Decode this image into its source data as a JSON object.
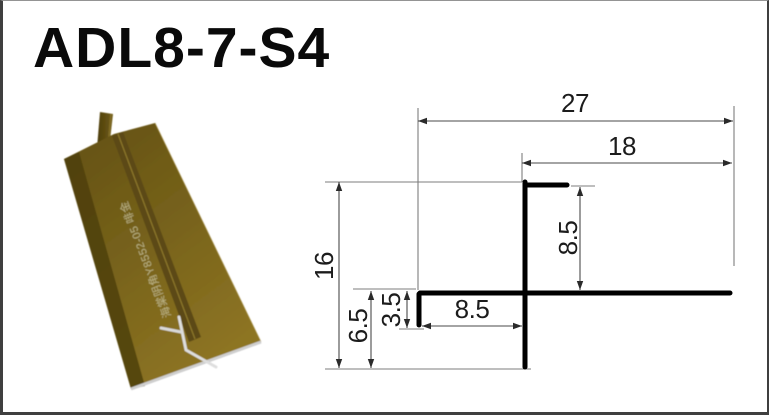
{
  "page": {
    "title": "ADL8-7-S4",
    "background": "#ffffff",
    "border_color": "#3f3f3f"
  },
  "product_photo": {
    "printed_text": "海棠阴角Y8552-05 啡金",
    "colors": {
      "gold_face": "#7a6419",
      "gold_dark": "#57460f",
      "gold_light": "#8d7422",
      "aluminium_edge": "#d9d9d9"
    }
  },
  "drawing": {
    "line_color": "#000000",
    "dimensions": {
      "total_width": "27",
      "right_width": "18",
      "total_height": "16",
      "lower_height": "6.5",
      "lip_height": "3.5",
      "slot_width": "8.5",
      "stem_height": "8.5"
    }
  }
}
